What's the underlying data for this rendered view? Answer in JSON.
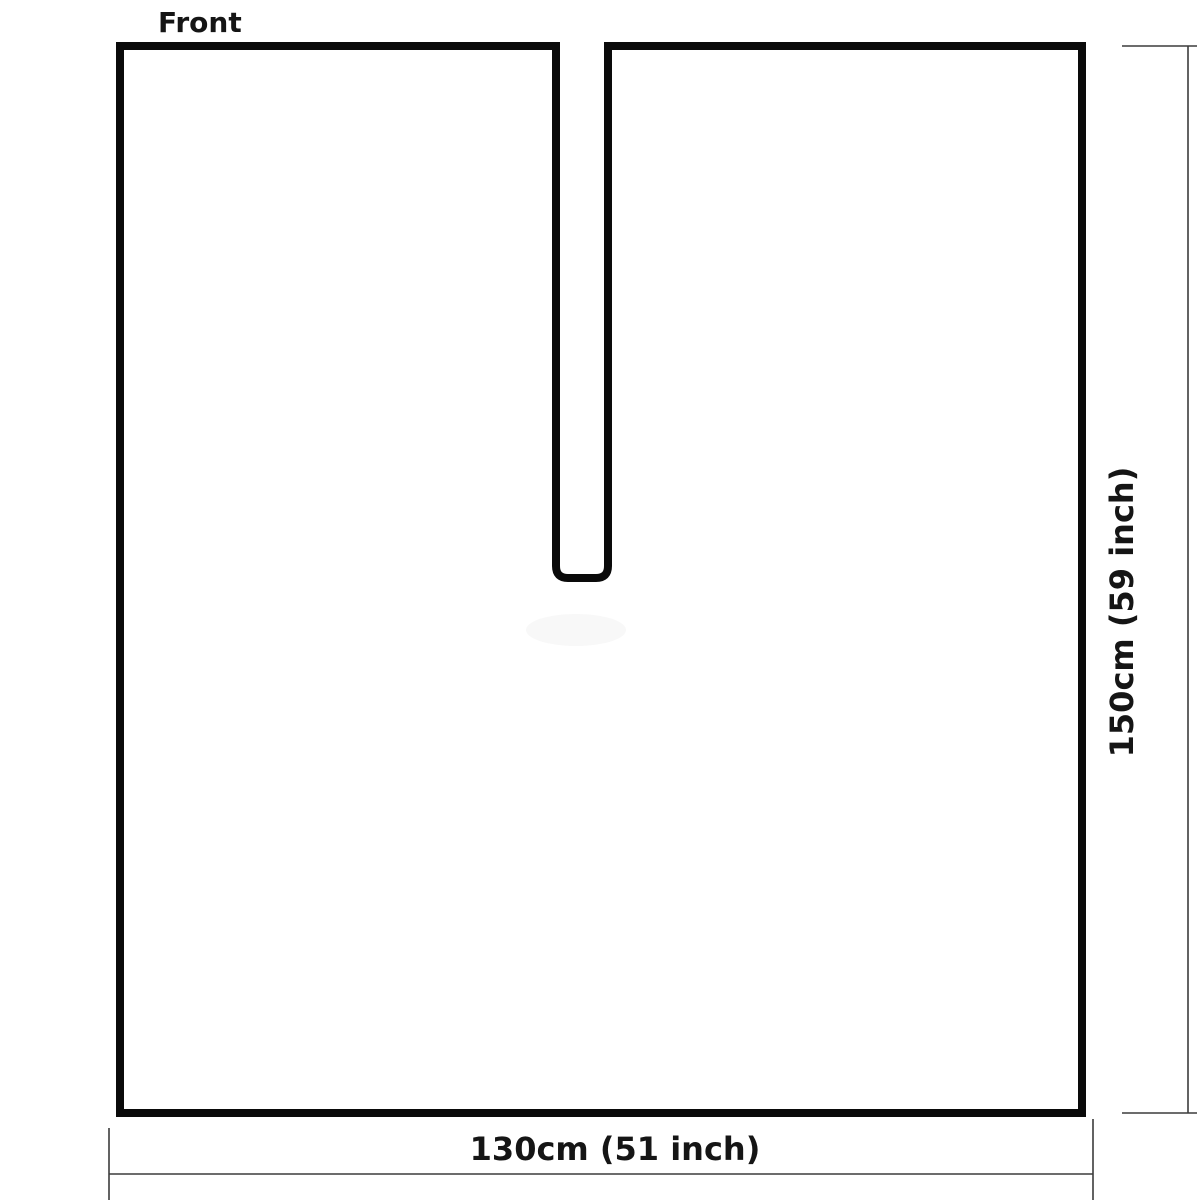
{
  "diagram": {
    "piece_label": "Front",
    "width_dimension": "130cm (51 inch)",
    "height_dimension": "150cm (59 inch)",
    "description": "Garment front panel pattern: rectangle with center neck slit from top edge"
  },
  "colors": {
    "background": "#ffffff",
    "outline": "#0a0a0a",
    "dimension_lines": "#3c3c3c",
    "label_text": "#151515"
  }
}
